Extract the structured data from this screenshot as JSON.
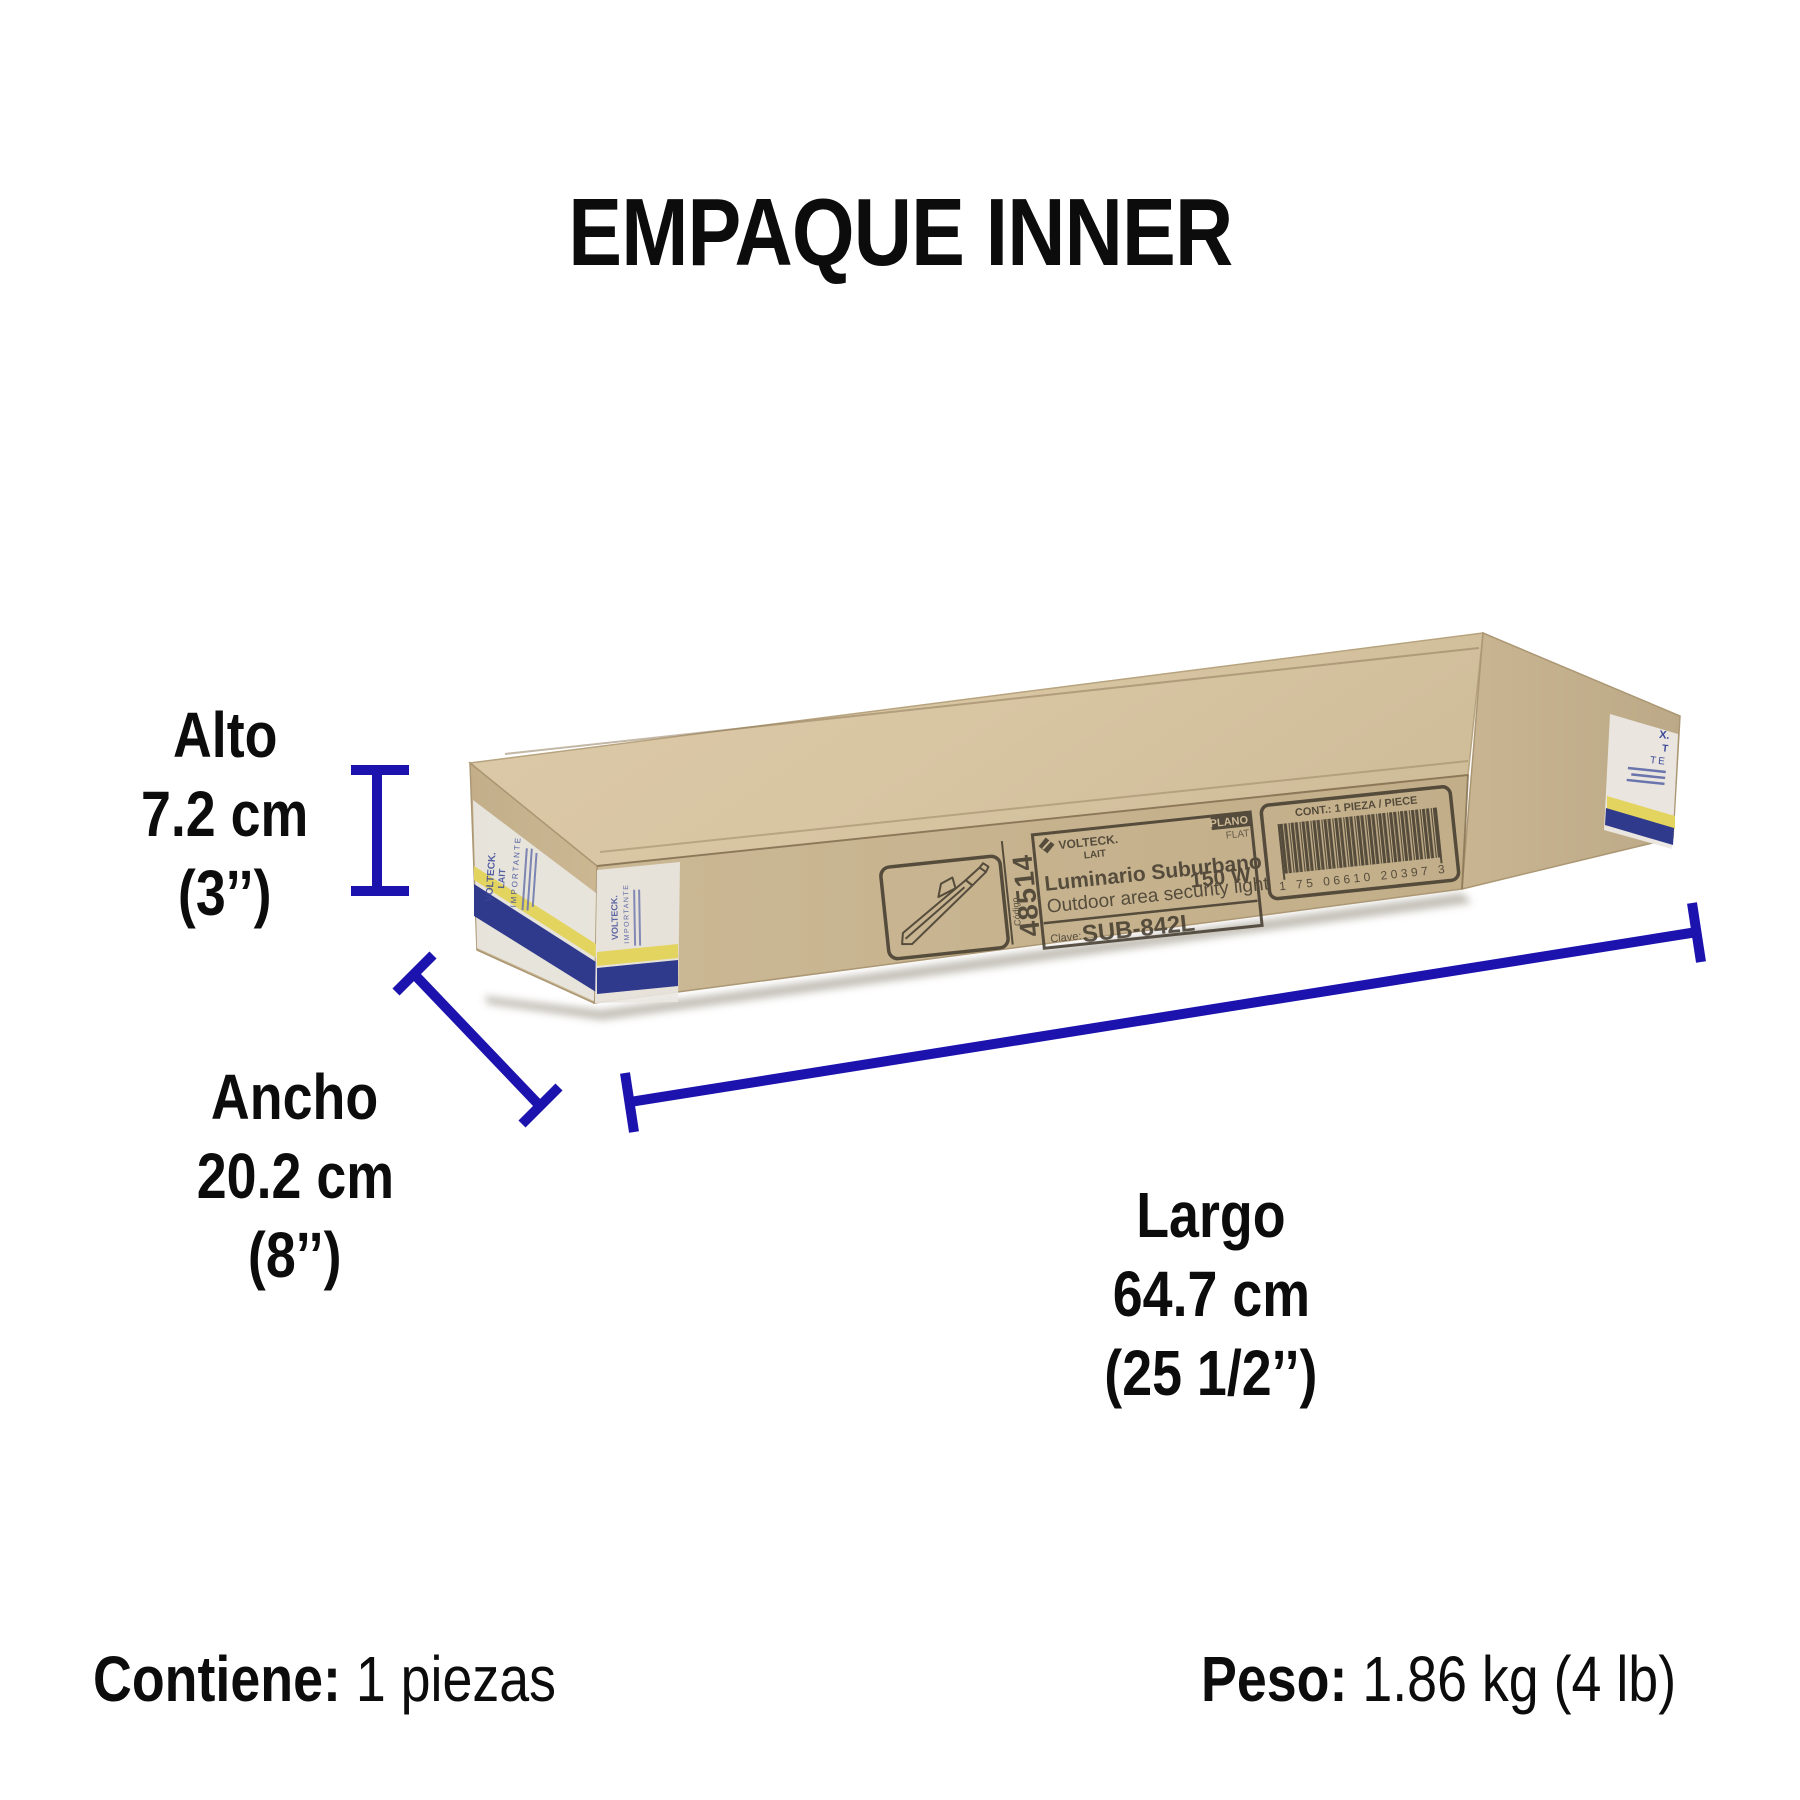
{
  "title": "EMPAQUE INNER",
  "dimensions": {
    "alto": {
      "label": "Alto",
      "metric": "7.2 cm",
      "imperial": "(3’’)"
    },
    "ancho": {
      "label": "Ancho",
      "metric": "20.2 cm",
      "imperial": "(8’’)"
    },
    "largo": {
      "label": "Largo",
      "metric": "64.7 cm",
      "imperial": "(25 1/2’’)"
    }
  },
  "footer": {
    "contains_label": "Contiene:",
    "contains_value": "1 piezas",
    "weight_label": "Peso:",
    "weight_value": "1.86 kg (4 lb)"
  },
  "box_label": {
    "codigo_label": "Código",
    "codigo": "48514",
    "brand": "VOLTECK.",
    "brand_sub": "LAIT",
    "product_es": "Luminario Suburbano",
    "product_en": "Outdoor area security light",
    "wattage": "150 W",
    "clave_label": "Clave:",
    "clave": "SUB-842L",
    "flat_es": "PLANO",
    "flat_en": "FLAT",
    "content": "CONT.:  1 PIEZA / PIECE",
    "barcode_digits": "1 75 06610 20397 3"
  },
  "tape": {
    "brand": "VOLTECK.",
    "brand_sub": "LAIT",
    "note": "IMPORTANTE",
    "right_fragments": [
      "X.",
      "T",
      "TE"
    ]
  },
  "colors": {
    "dimension_blue": "#1c12ae",
    "tape_navy": "#2f3a8c",
    "tape_yellow": "#e3d45f",
    "label_ink": "#463e31",
    "kraft_top": "#d9c6a4",
    "kraft_front": "#c7b490"
  }
}
